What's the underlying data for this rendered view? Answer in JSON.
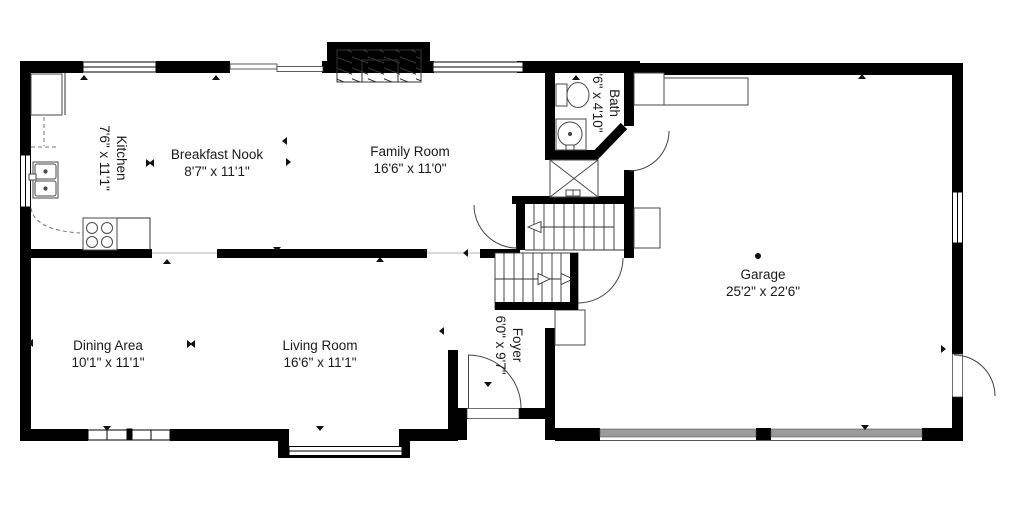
{
  "plan_type": "floor-plan",
  "colors": {
    "wall": "#000000",
    "background": "#ffffff",
    "garage_door": "#9b9b9b",
    "fixture_line": "#4a4a4a",
    "text": "#1a1a1a"
  },
  "rooms": [
    {
      "id": "kitchen",
      "name": "Kitchen",
      "dims": "7'6\" x 11'1\"",
      "rotated": true
    },
    {
      "id": "breakfast-nook",
      "name": "Breakfast Nook",
      "dims": "8'7\" x 11'1\"",
      "rotated": false
    },
    {
      "id": "family-room",
      "name": "Family Room",
      "dims": "16'6\" x 11'0\"",
      "rotated": false
    },
    {
      "id": "bath",
      "name": "Bath",
      "dims": "'6\" x 4'10\"",
      "rotated": true
    },
    {
      "id": "garage",
      "name": "Garage",
      "dims": "25'2\" x 22'6\"",
      "rotated": false
    },
    {
      "id": "dining-area",
      "name": "Dining Area",
      "dims": "10'1\" x 11'1\"",
      "rotated": false
    },
    {
      "id": "living-room",
      "name": "Living Room",
      "dims": "16'6\" x 11'1\"",
      "rotated": false
    },
    {
      "id": "foyer",
      "name": "Foyer",
      "dims": "6'0\" x 9'7\"",
      "rotated": true
    }
  ],
  "markers": [
    {
      "x": 84,
      "y": 80,
      "dir": "up"
    },
    {
      "x": 216,
      "y": 80,
      "dir": "up"
    },
    {
      "x": 576,
      "y": 80,
      "dir": "up"
    },
    {
      "x": 862,
      "y": 79,
      "dir": "up"
    },
    {
      "x": 167,
      "y": 264,
      "dir": "up"
    },
    {
      "x": 380,
      "y": 262,
      "dir": "up"
    },
    {
      "x": 277,
      "y": 247,
      "dir": "down"
    },
    {
      "x": 107,
      "y": 426,
      "dir": "down"
    },
    {
      "x": 320,
      "y": 426,
      "dir": "down"
    },
    {
      "x": 865,
      "y": 425,
      "dir": "down"
    },
    {
      "x": 33,
      "y": 343,
      "dir": "left"
    },
    {
      "x": 941,
      "y": 349,
      "dir": "right"
    },
    {
      "x": 146,
      "y": 163,
      "dir": "right"
    },
    {
      "x": 154,
      "y": 163,
      "dir": "left"
    },
    {
      "x": 187,
      "y": 344,
      "dir": "right"
    },
    {
      "x": 195,
      "y": 344,
      "dir": "left"
    },
    {
      "x": 287,
      "y": 141,
      "dir": "left"
    },
    {
      "x": 286,
      "y": 162,
      "dir": "right"
    },
    {
      "x": 444,
      "y": 331,
      "dir": "left"
    },
    {
      "x": 488,
      "y": 382,
      "dir": "down"
    },
    {
      "x": 468,
      "y": 253,
      "dir": "left"
    }
  ]
}
